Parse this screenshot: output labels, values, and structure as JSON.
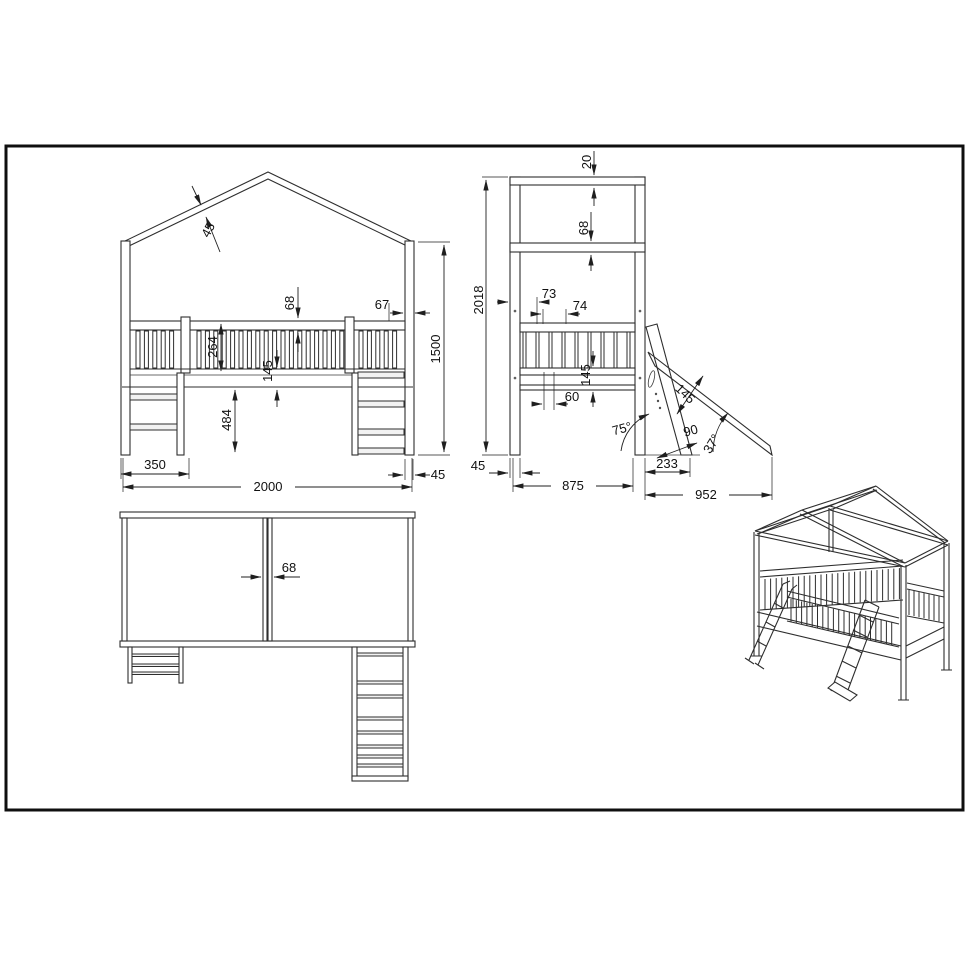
{
  "colors": {
    "line": "#2e2e2e",
    "dimension": "#1f1f1f",
    "border": "#0f0f0f",
    "background": "#ffffff"
  },
  "front_view": {
    "dimensions": {
      "roof_beam_thickness": "45",
      "rail_beam_height": "68",
      "rail_end_gap": "67",
      "railing_height": "264",
      "frame_height": "145",
      "under_clearance": "484",
      "ladder_width": "350",
      "bed_length": "2000",
      "post_width": "45",
      "eave_height": "1500"
    }
  },
  "side_view": {
    "dimensions": {
      "ridge_beam": "20",
      "eave_beam": "68",
      "post_offset": "73",
      "slat_pitch": "74",
      "total_height": "2018",
      "frame_height": "145",
      "slat_gap": "60",
      "ladder_angle": "75°",
      "ladder_board_width": "90",
      "slide_board_width": "145",
      "slide_angle": "37°",
      "ladder_foot_offset": "233",
      "post_width": "45",
      "bed_depth": "875",
      "slide_reach": "952"
    }
  },
  "top_view": {
    "dimensions": {
      "center_beam_width": "68"
    }
  }
}
